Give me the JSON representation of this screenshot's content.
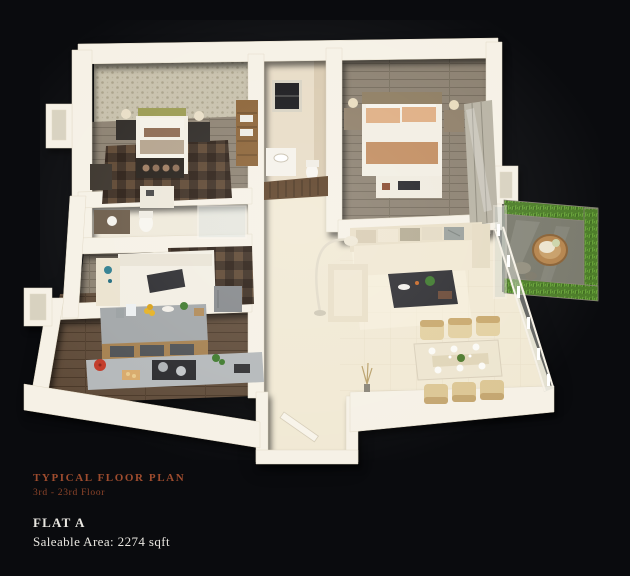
{
  "caption": {
    "title": "TYPICAL FLOOR PLAN",
    "subtitle": "3rd - 23rd Floor",
    "flat_label": "FLAT A",
    "area_label": "Saleable Area: 2274 sqft"
  },
  "palette": {
    "bg": "#0a0b0e",
    "wall": "#f6f1e6",
    "wall-shadow": "#d8cfba",
    "cream-floor": "#f1e9d4",
    "tile-line": "#d8cbae",
    "wood-light": "#8b8070",
    "wood-dark": "#5f4b39",
    "wallpaper": "#c7c0ab",
    "wallpaper-dot": "#a9a189",
    "rug-dark": "#3c2d21",
    "rug-mid": "#5c4530",
    "bed-white": "#f2eee3",
    "peach": "#dfae83",
    "tan": "#c28d60",
    "olive": "#9a9a50",
    "dark-furniture": "#2c2824",
    "counter-gray": "#a9adaf",
    "island-wood": "#a5804f",
    "grass": "#4c7d28",
    "grass-dark": "#2f5516",
    "balcony-floor": "#7a7a6d",
    "wicker": "#b5854e",
    "chair-tan": "#e3d0a1",
    "glass": "#ccd4cf",
    "plant-green": "#3f7a2e",
    "accent-text": "#9e4c2e",
    "caption-text": "#e9e7e1"
  }
}
